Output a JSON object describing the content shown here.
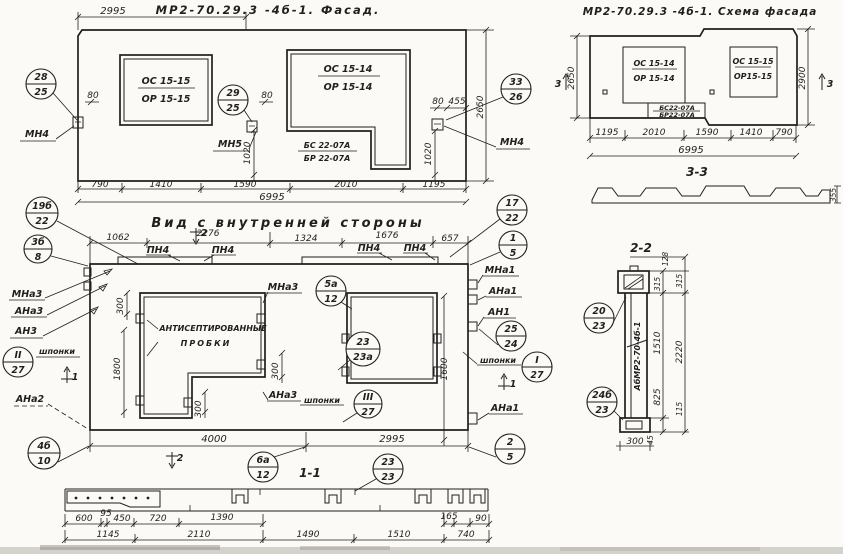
{
  "colors": {
    "ink": "#1f1f1f",
    "paper": "#fbfaf6"
  },
  "facade": {
    "title": "МР2-70.29.3 -4б-1. Фасад.",
    "window1": {
      "l1": "ОС 15-15",
      "l2": "ОР 15-15"
    },
    "window2": {
      "l1": "ОС 15-14",
      "l2": "ОР 15-14"
    },
    "sill": {
      "l1": "БС 22-07А",
      "l2": "БР 22-07А"
    },
    "anchors": [
      "МН4",
      "МН5",
      "МН4"
    ],
    "dims": {
      "top": "2995",
      "total": "6995",
      "height": "2650",
      "bottom": [
        "790",
        "1410",
        "1590",
        "2010",
        "1195"
      ],
      "off80a": "80",
      "off80b": "80",
      "off80c": "80",
      "off455": "455",
      "v1020a": "1020",
      "v1020b": "1020"
    },
    "callouts": [
      {
        "t": "28",
        "b": "25"
      },
      {
        "t": "29",
        "b": "25"
      },
      {
        "t": "33",
        "b": "26"
      }
    ]
  },
  "inner": {
    "title": "Вид с внутренней стороны",
    "dims_top": [
      "1062",
      "2276",
      "1324",
      "1676",
      "657"
    ],
    "plates": [
      "ПН4",
      "ПН4",
      "ПН4",
      "ПН4"
    ],
    "left_labels": [
      "МНа3",
      "АНа3",
      "АН3",
      "шпонки",
      "АНа2"
    ],
    "mid_labels": [
      "МНа3",
      "АНа3",
      "шпонки"
    ],
    "right_labels": [
      "МНа1",
      "АНа1",
      "АН1",
      "шпонки",
      "АНа1"
    ],
    "note": {
      "l1": "АНТИСЕПТИРОВАННЫЕ",
      "l2": "ПРОБКИ"
    },
    "dims": {
      "v300a": "300",
      "v1800": "1800",
      "v300b": "300",
      "v300c": "300",
      "v1600": "1600",
      "w4000": "4000",
      "w2995": "2995"
    },
    "marks": {
      "top": "2",
      "left": "1",
      "right": "1",
      "bottom": "2"
    },
    "callouts": [
      {
        "t": "19б",
        "b": "22"
      },
      {
        "t": "3б",
        "b": "8"
      },
      {
        "t": "17",
        "b": "22"
      },
      {
        "t": "1",
        "b": "5"
      },
      {
        "t": "5а",
        "b": "12"
      },
      {
        "t": "23",
        "b": "23а"
      },
      {
        "t": "25",
        "b": "24"
      },
      {
        "t": "II",
        "b": "27"
      },
      {
        "t": "III",
        "b": "27"
      },
      {
        "t": "I",
        "b": "27"
      },
      {
        "t": "4б",
        "b": "10"
      },
      {
        "t": "6а",
        "b": "12"
      },
      {
        "t": "2",
        "b": "5"
      },
      {
        "t": "23",
        "b": "23"
      }
    ]
  },
  "section11": {
    "label": "1-1",
    "dims_upper": [
      "600",
      "95",
      "450",
      "720",
      "1390",
      "165",
      "90"
    ],
    "dims_lower": [
      "1145",
      "2110",
      "1490",
      "1510",
      "740"
    ]
  },
  "schema": {
    "title": "МР2-70.29.3 -4б-1. Схема фасада",
    "window_left": {
      "l1": "ОС 15-14",
      "l2": "ОР 15-14"
    },
    "window_right": {
      "l1": "ОС 15-15",
      "l2": "ОР15-15"
    },
    "sill": {
      "l1": "БС22-07А",
      "l2": "БР22-07А"
    },
    "dims_bottom": [
      "1195",
      "2010",
      "1590",
      "1410",
      "790"
    ],
    "dims": {
      "total": "6995",
      "height_left": "2650",
      "height_right": "2900"
    },
    "cut_mark": "3"
  },
  "section33": {
    "label": "3-3",
    "thickness": "355"
  },
  "section22": {
    "label": "2-2",
    "marking": "АбМР2-70-4б-1",
    "dims": {
      "d128": "128",
      "d315a": "315",
      "d315b": "315",
      "d1510": "1510",
      "d2220": "2220",
      "d825": "825",
      "d115": "115",
      "d45": "45",
      "d300": "300"
    },
    "callouts": [
      {
        "t": "20",
        "b": "23"
      },
      {
        "t": "24б",
        "b": "23"
      }
    ]
  }
}
